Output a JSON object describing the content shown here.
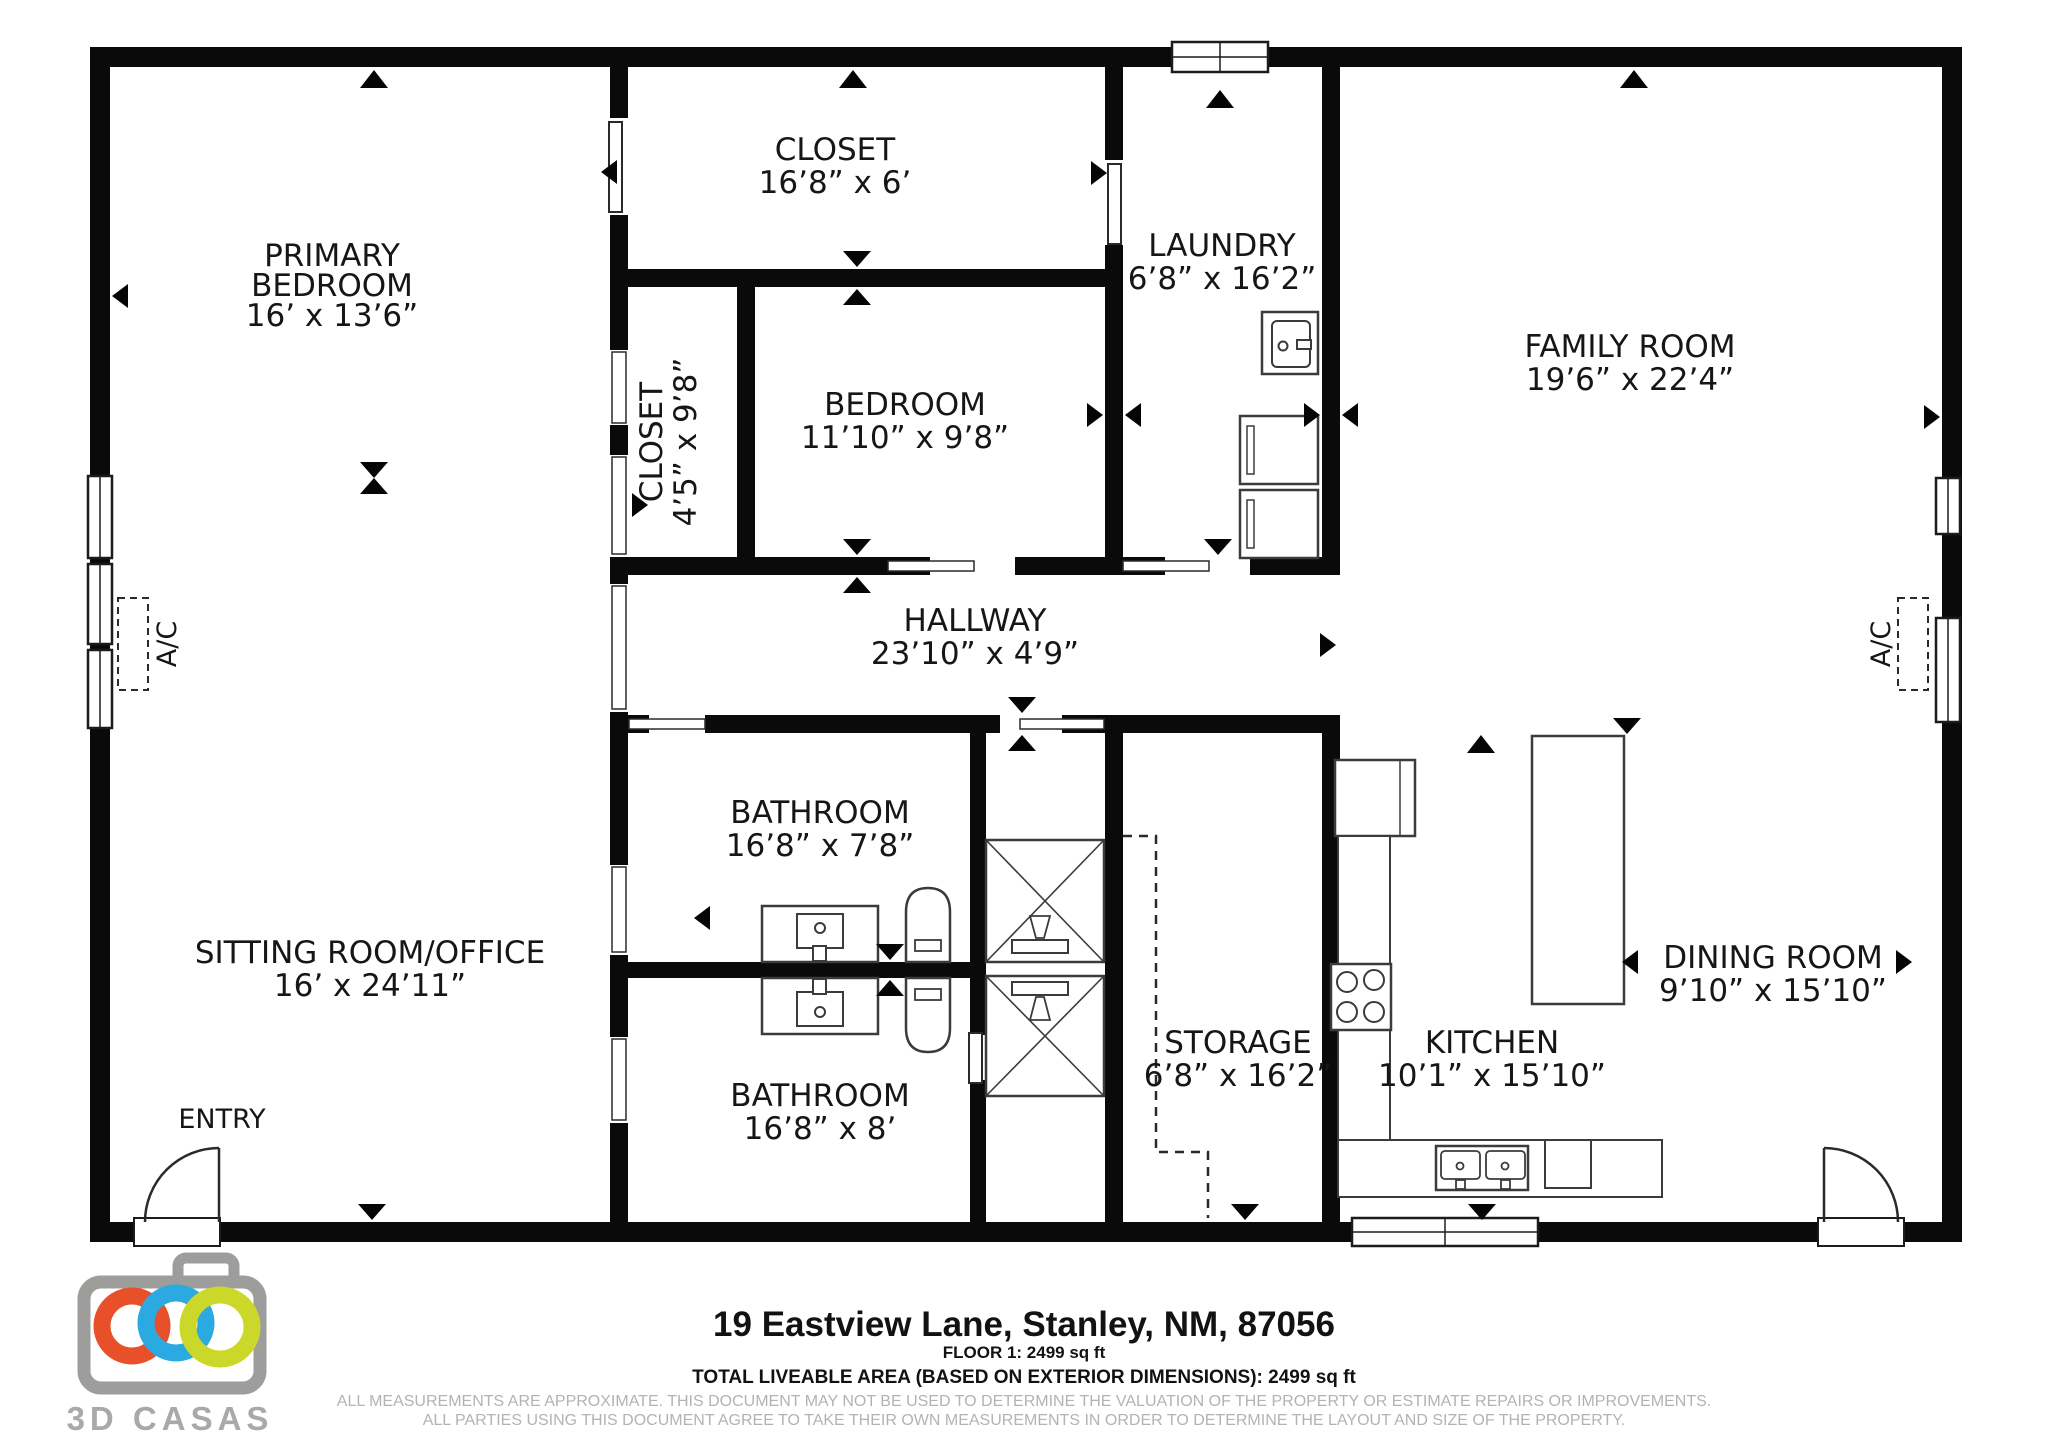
{
  "plan": {
    "rooms": {
      "primary_bedroom": {
        "line1": "PRIMARY",
        "line2": "BEDROOM",
        "dims": "16’ x 13’6”"
      },
      "closet_top": {
        "label": "CLOSET",
        "dims": "16’8” x 6’"
      },
      "closet_small": {
        "label": "CLOSET",
        "dims": "4’5” x 9’8”"
      },
      "bedroom": {
        "label": "BEDROOM",
        "dims": "11’10” x 9’8”"
      },
      "laundry": {
        "label": "LAUNDRY",
        "dims": "6’8” x 16’2”"
      },
      "family_room": {
        "label": "FAMILY ROOM",
        "dims": "19’6” x 22’4”"
      },
      "hallway": {
        "label": "HALLWAY",
        "dims": "23’10” x 4’9”"
      },
      "bathroom_top": {
        "label": "BATHROOM",
        "dims": "16’8” x 7’8”"
      },
      "bathroom_bottom": {
        "label": "BATHROOM",
        "dims": "16’8” x 8’"
      },
      "sitting_room": {
        "label": "SITTING ROOM/OFFICE",
        "dims": "16’ x 24’11”"
      },
      "storage": {
        "label": "STORAGE",
        "dims": "6’8” x 16’2”"
      },
      "kitchen": {
        "label": "KITCHEN",
        "dims": "10’1” x 15’10”"
      },
      "dining_room": {
        "label": "DINING ROOM",
        "dims": "9’10” x 15’10”"
      },
      "entry": {
        "label": "ENTRY"
      },
      "ac_left": {
        "label": "A/C"
      },
      "ac_right": {
        "label": "A/C"
      }
    }
  },
  "footer": {
    "address": "19 Eastview Lane, Stanley, NM, 87056",
    "floor_area": "FLOOR 1: 2499 sq ft",
    "total_area": "TOTAL LIVEABLE AREA (BASED ON EXTERIOR DIMENSIONS): 2499 sq ft",
    "disclaimer_line1": "ALL MEASUREMENTS ARE APPROXIMATE. THIS DOCUMENT MAY NOT BE USED TO DETERMINE THE VALUATION OF THE PROPERTY OR ESTIMATE REPAIRS OR IMPROVEMENTS.",
    "disclaimer_line2": "ALL PARTIES USING THIS DOCUMENT AGREE TO TAKE THEIR OWN MEASUREMENTS IN ORDER TO DETERMINE THE LAYOUT AND SIZE OF THE PROPERTY."
  },
  "logo": {
    "brand": "3D CASAS",
    "camera_color": "#9d9d9c",
    "ring_orange": "#e8502a",
    "ring_blue": "#2aaae1",
    "ring_green": "#ccd829",
    "text_color": "#a9a9a8"
  },
  "colors": {
    "wall": "#0a0a0a",
    "background": "#ffffff",
    "disclaimer_text": "#b3b3b3"
  }
}
